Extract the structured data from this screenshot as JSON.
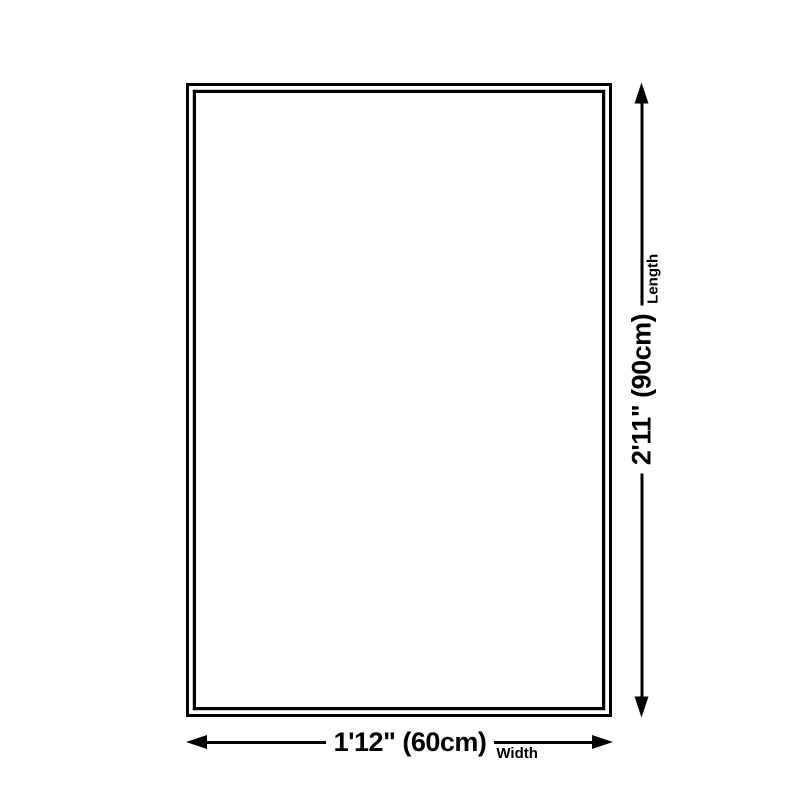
{
  "colors": {
    "bg": "#ffffff",
    "line": "#000000",
    "text": "#000000",
    "highlight": "#c8c8c8"
  },
  "diagram": {
    "shape": "rectangle-outline"
  },
  "dimensions": {
    "width": {
      "value": "1'12\" (60cm)",
      "label": "Width"
    },
    "length": {
      "value": "2'11\" (90cm)",
      "label": "Length"
    }
  }
}
